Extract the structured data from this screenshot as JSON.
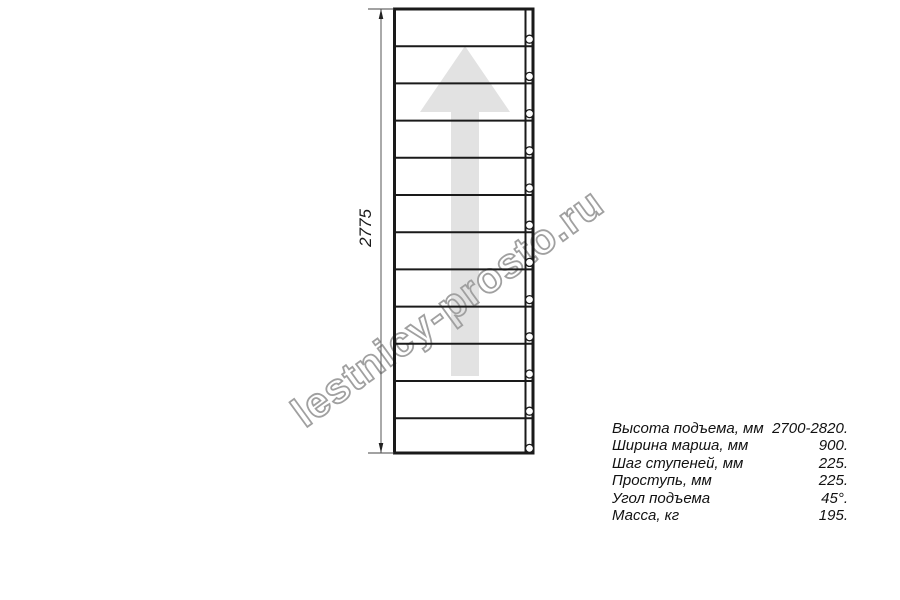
{
  "watermark": {
    "text": "lestnicy-prosto.ru"
  },
  "diagram": {
    "dimension_label": "2775",
    "steps_count": 12,
    "direction": "up",
    "colors": {
      "line": "#1a1a1a",
      "arrow_fill": "#e2e2e2",
      "watermark": "#a0a0a0",
      "dimension": "#555555"
    }
  },
  "specs": {
    "rows": [
      {
        "label": "Высота подъема, мм",
        "value": "2700-2820."
      },
      {
        "label": "Ширина марша, мм",
        "value": "900."
      },
      {
        "label": "Шаг ступеней, мм",
        "value": "225."
      },
      {
        "label": "Проступь, мм",
        "value": "225."
      },
      {
        "label": "Угол подъема",
        "value": "45°."
      },
      {
        "label": "Масса, кг",
        "value": "195."
      }
    ]
  }
}
